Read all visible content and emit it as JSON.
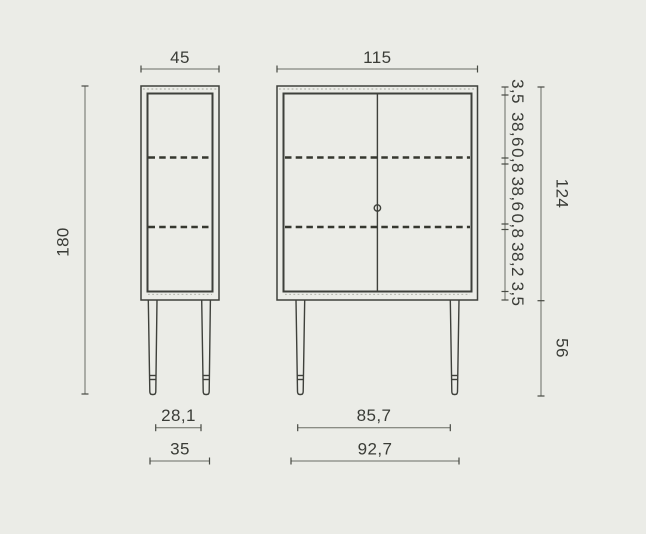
{
  "drawing": {
    "subject": "cabinet-two-view-technical-drawing",
    "colors": {
      "background": "#ebece7",
      "object_line": "#3e403b",
      "dimension_line": "#6a6d64",
      "text": "#3a3c37"
    },
    "views": {
      "side": {
        "name": "side-view"
      },
      "front": {
        "name": "front-view"
      }
    },
    "dims": {
      "side_width": "45",
      "front_width": "115",
      "overall_height": "180",
      "carcass_height": "124",
      "leg_height": "56",
      "vertical_segments": [
        "3,5",
        "38,6",
        "0,8",
        "38,6",
        "0,8",
        "38,2",
        "3,5"
      ],
      "side_feet_inner": "28,1",
      "side_feet_outer": "35",
      "front_feet_inner": "85,7",
      "front_feet_outer": "92,7"
    }
  }
}
